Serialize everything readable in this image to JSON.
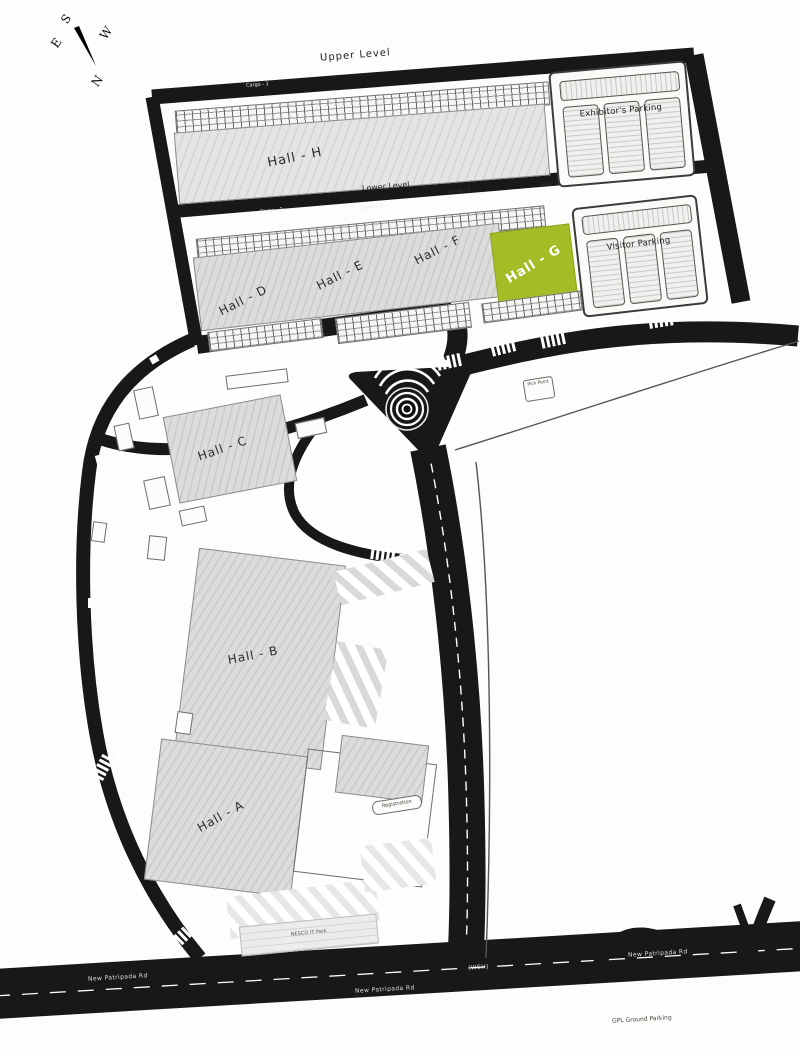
{
  "compass": {
    "n": "N",
    "e": "E",
    "s": "S",
    "w": "W"
  },
  "levels": {
    "upper": "Upper Level",
    "lower": "Lower Level"
  },
  "halls": {
    "h": "Hall - H",
    "d": "Hall - D",
    "e": "Hall - E",
    "f": "Hall - F",
    "g": "Hall - G",
    "c": "Hall - C",
    "b": "Hall - B",
    "a": "Hall - A"
  },
  "parking": {
    "exhibitor": "Exhibitor's Parking",
    "visitor": "Visitor Parking",
    "ground_note": "GPL Ground Parking"
  },
  "cargo": {
    "c1": "Cargo - 1",
    "c2": "Cargo - 4",
    "c3": "Cargo - 4",
    "c4": "Cargo - 3",
    "c5": "Cargo - 2"
  },
  "roads": {
    "main_name": "New Patripada Rd",
    "marker": "(WEH)"
  },
  "misc": {
    "registration": "Registration",
    "pick_point": "Pick Point",
    "it_bldg": "NESCO IT Park"
  },
  "colors": {
    "road": "#181818",
    "hall_fill": "#dcdcda",
    "hall_g_green": "#a4bd26",
    "crosswalk_white": "#ffffff"
  }
}
